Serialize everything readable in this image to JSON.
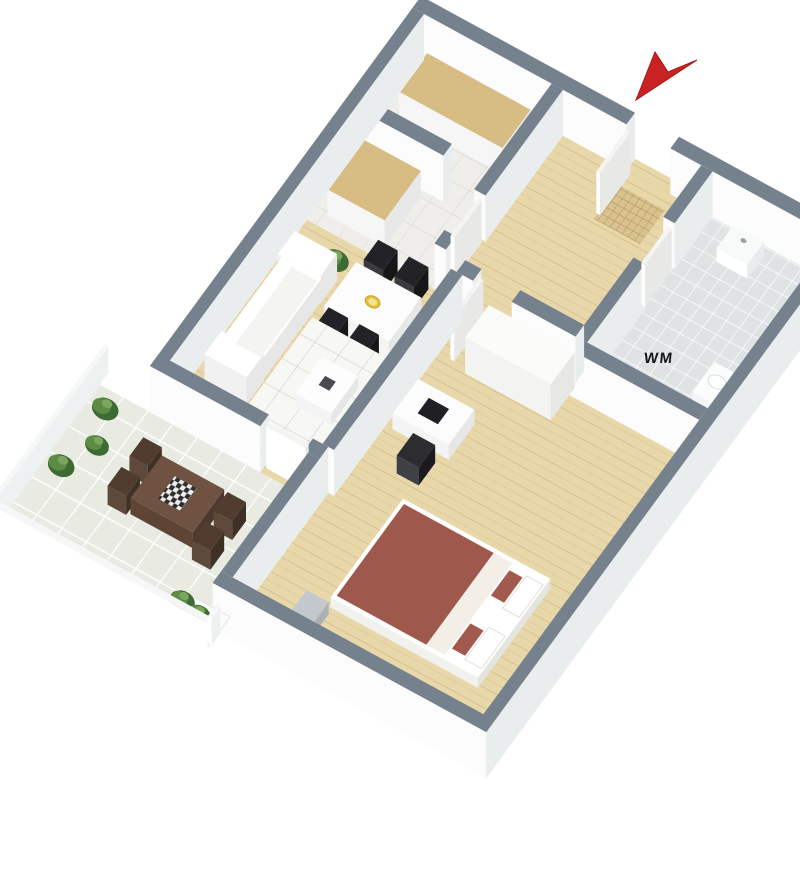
{
  "meta": {
    "title": "3D isometric floor plan - one-bedroom apartment with balcony",
    "background": "#ffffff"
  },
  "labels": {
    "washing_machine": "WM"
  },
  "view": {
    "eu": [
      44,
      24
    ],
    "ev": [
      -33,
      45
    ],
    "origin": [
      424,
      60
    ],
    "wall_height": 46,
    "canvas": [
      800,
      891
    ]
  },
  "palette": {
    "wall_cap": "#75828e",
    "wall_face_light": "#fcfcfc",
    "wall_face_dark": "#e9edee",
    "wood_floor": "#e8d7a9",
    "kitchen_floor": "#efeeea",
    "bath_floor": "#dfe3e4",
    "balcony_tile": "#e9ebe3",
    "counter_wood": "#d7bd84",
    "bed_red": "#9e584c",
    "arrow_red": "#c92222",
    "plant_green": "#3e6b33",
    "furniture_dark": "#232327"
  },
  "scene": {
    "items": [
      {
        "n": "kitchen-floor",
        "t": "floor",
        "x": 0,
        "y": 0,
        "w": 2.9,
        "h": 3.55,
        "pat": "patK"
      },
      {
        "n": "hall-floor",
        "t": "floor",
        "x": 2.9,
        "y": 0,
        "w": 3.4,
        "h": 3.55,
        "pat": "patWood"
      },
      {
        "n": "bathroom-floor",
        "t": "floor",
        "x": 6.3,
        "y": 0,
        "w": 3.0,
        "h": 3.8,
        "pat": "patBath"
      },
      {
        "n": "living-room-floor",
        "t": "floor",
        "x": 0,
        "y": 3.55,
        "w": 3.47,
        "h": 4.15,
        "pat": "patWood"
      },
      {
        "n": "bedroom-floor",
        "t": "floor",
        "x": 3.6,
        "y": 3.81,
        "w": 5.7,
        "h": 6.79,
        "pat": "patWood"
      },
      {
        "n": "balcony-floor",
        "t": "floor",
        "x": -1.5,
        "y": 7.96,
        "w": 4.94,
        "h": 3.14,
        "pat": "patBal"
      },
      {
        "n": "entry-threshold",
        "t": "flat",
        "x": 4.6,
        "y": -0.26,
        "w": 1.0,
        "h": 0.26,
        "pat": "patWood"
      },
      {
        "n": "kitchen-threshold",
        "t": "flat",
        "x": 2.9,
        "y": 2.35,
        "w": 0.26,
        "h": 0.9,
        "pat": "patWood"
      },
      {
        "n": "bath-threshold",
        "t": "flat",
        "x": 6.3,
        "y": 1.15,
        "w": 0.26,
        "h": 0.9,
        "pat": "patBath"
      },
      {
        "n": "bedroom-threshold",
        "t": "flat",
        "x": 3.97,
        "y": 3.55,
        "w": 0.88,
        "h": 0.26,
        "pat": "patWood"
      },
      {
        "n": "balcony-threshold",
        "t": "flat",
        "x": 2.25,
        "y": 7.7,
        "w": 1.0,
        "h": 0.26,
        "pat": "patWood"
      },
      {
        "n": "doormat",
        "t": "flat",
        "x": 4.65,
        "y": 0.3,
        "w": 1.05,
        "h": 0.75,
        "pat": "patMat"
      },
      {
        "n": "wall-top-left-segment",
        "t": "prism",
        "x": -0.26,
        "y": -0.26,
        "w": 4.86,
        "h": 0.26,
        "cap": "#75828e"
      },
      {
        "n": "wall-top-right-segment",
        "t": "prism",
        "x": 5.6,
        "y": -0.26,
        "w": 3.96,
        "h": 0.26,
        "cap": "#75828e"
      },
      {
        "n": "entrance-door",
        "t": "prism",
        "x": 4.62,
        "y": 0.02,
        "w": 0.09,
        "h": 0.92,
        "ht": 42,
        "cap": "#f4f4f2",
        "f1": "#ffffff",
        "f2": "#e8e8e6"
      },
      {
        "n": "bathroom-sink",
        "t": "prism",
        "x": 7.25,
        "y": 0.3,
        "w": 0.7,
        "h": 0.5,
        "z0": 8,
        "ht": 14,
        "cap": "#f8fafa",
        "f1": "#ffffff",
        "f2": "#e8ecee"
      },
      {
        "n": "sink-tap",
        "t": "dot",
        "x": 7.6,
        "y": 0.45,
        "z": 22,
        "r": 0.07,
        "fill": "#9aa4ab"
      },
      {
        "n": "kitchen-counter-far",
        "t": "prism",
        "x": 0.28,
        "y": 0.28,
        "w": 2.35,
        "h": 0.85,
        "ht": 26,
        "cap": "#d7bd84",
        "f1": "#f6f6f6",
        "f2": "#e8e8e8"
      },
      {
        "n": "kitchen-divider-wall",
        "t": "prism",
        "x": 0,
        "y": 1.82,
        "w": 2.0,
        "h": 0.26,
        "cap": "#75828e"
      },
      {
        "n": "kitchen-counter-near",
        "t": "prism",
        "x": 0.28,
        "y": 2.2,
        "w": 1.3,
        "h": 1.1,
        "ht": 26,
        "cap": "#d7bd84",
        "f1": "#f6f6f6",
        "f2": "#e8e8e8"
      },
      {
        "n": "kitchen-wall-a",
        "t": "prism",
        "x": 2.9,
        "y": 0,
        "w": 0.26,
        "h": 2.35,
        "cap": "#75828e"
      },
      {
        "n": "kitchen-wall-b",
        "t": "prism",
        "x": 2.9,
        "y": 3.25,
        "w": 0.26,
        "h": 0.3,
        "cap": "#75828e"
      },
      {
        "n": "kitchen-door",
        "t": "prism",
        "x": 3.02,
        "y": 2.4,
        "w": 0.09,
        "h": 0.82,
        "ht": 42,
        "cap": "#f4f4f2",
        "f1": "#ffffff",
        "f2": "#e8e8e6"
      },
      {
        "n": "wall-left-exterior",
        "t": "prism",
        "x": -0.26,
        "y": 0,
        "w": 0.26,
        "h": 7.96,
        "cap": "#75828e"
      },
      {
        "n": "bathroom-wall-a",
        "t": "prism",
        "x": 6.3,
        "y": 0,
        "w": 0.26,
        "h": 1.15,
        "cap": "#75828e"
      },
      {
        "n": "bathroom-wall-b",
        "t": "prism",
        "x": 6.3,
        "y": 2.05,
        "w": 0.26,
        "h": 1.75,
        "cap": "#75828e"
      },
      {
        "n": "bathroom-door",
        "t": "prism",
        "x": 6.44,
        "y": 1.2,
        "w": 0.09,
        "h": 0.8,
        "ht": 42,
        "cap": "#f4f4f2",
        "f1": "#ffffff",
        "f2": "#e8e8e6"
      },
      {
        "n": "toilet",
        "t": "prism",
        "x": 8.45,
        "y": 2.45,
        "w": 0.55,
        "h": 0.68,
        "ht": 11,
        "cap": "#fbfdfd",
        "f1": "#f2f5f5",
        "f2": "#e2e7e8"
      },
      {
        "n": "toilet-lid",
        "t": "dot",
        "x": 8.72,
        "y": 2.75,
        "z": 11,
        "r": 0.2,
        "fill": "#ffffff",
        "stroke": "#d9dee1"
      },
      {
        "n": "bathroom-bottom-wall",
        "t": "prism",
        "x": 6.3,
        "y": 3.8,
        "w": 3.0,
        "h": 0.26,
        "cap": "#75828e"
      },
      {
        "n": "hall-wall-a",
        "t": "prism",
        "x": 3.6,
        "y": 3.55,
        "w": 0.37,
        "h": 0.26,
        "cap": "#75828e"
      },
      {
        "n": "hall-wall-b",
        "t": "prism",
        "x": 4.85,
        "y": 3.55,
        "w": 1.45,
        "h": 0.26,
        "cap": "#75828e"
      },
      {
        "n": "bedroom-door",
        "t": "prism",
        "x": 3.99,
        "y": 3.64,
        "w": 0.09,
        "h": 0.88,
        "ht": 42,
        "cap": "#f4f4f2",
        "f1": "#ffffff",
        "f2": "#e8e8e6"
      },
      {
        "n": "dining-plant",
        "t": "plant",
        "x": 0.95,
        "y": 3.95,
        "r": 0.3
      },
      {
        "n": "dining-chair",
        "t": "prism",
        "x": 1.66,
        "y": 3.6,
        "w": 0.44,
        "h": 0.44,
        "ht": 22,
        "cap": "#232327",
        "f1": "#3a3a40",
        "f2": "#17171a"
      },
      {
        "n": "dining-chair",
        "t": "prism",
        "x": 2.36,
        "y": 3.6,
        "w": 0.44,
        "h": 0.44,
        "ht": 22,
        "cap": "#232327",
        "f1": "#3a3a40",
        "f2": "#17171a"
      },
      {
        "n": "dining-table",
        "t": "prism",
        "x": 1.52,
        "y": 4.08,
        "w": 1.48,
        "h": 0.98,
        "ht": 18,
        "cap": "#fcfcfc",
        "f1": "#f4f4f4",
        "f2": "#e6e8e8"
      },
      {
        "n": "fruit-bowl",
        "t": "dot",
        "x": 2.26,
        "y": 4.57,
        "z": 18,
        "r": 0.17,
        "fill": "#e6c23c",
        "stroke": "#c9a226"
      },
      {
        "n": "fruit-bowl-inner",
        "t": "dot",
        "x": 2.26,
        "y": 4.57,
        "z": 18,
        "r": 0.1,
        "fill": "#f4e49a"
      },
      {
        "n": "dining-chair",
        "t": "prism",
        "x": 1.66,
        "y": 5.1,
        "w": 0.44,
        "h": 0.44,
        "ht": 22,
        "cap": "#232327",
        "f1": "#3a3a40",
        "f2": "#17171a"
      },
      {
        "n": "dining-chair",
        "t": "prism",
        "x": 2.36,
        "y": 5.1,
        "w": 0.44,
        "h": 0.44,
        "ht": 22,
        "cap": "#232327",
        "f1": "#3a3a40",
        "f2": "#17171a"
      },
      {
        "n": "wardrobe",
        "t": "prism",
        "x": 4.4,
        "y": 3.9,
        "w": 1.95,
        "h": 0.72,
        "ht": 36,
        "cap": "#fbfbfa",
        "f1": "#f3f3f1",
        "f2": "#e7e7e4"
      },
      {
        "n": "living-rug",
        "t": "flat",
        "x": 1.25,
        "y": 5.05,
        "w": 2.2,
        "h": 2.5,
        "pat": "patRug"
      },
      {
        "n": "coffee-table",
        "t": "prism",
        "x": 2.02,
        "y": 5.78,
        "w": 0.82,
        "h": 0.82,
        "ht": 12,
        "cap": "#fdfdfd",
        "f1": "#f4f4f4",
        "f2": "#e6e8e8"
      },
      {
        "n": "coffee-table-item",
        "t": "flat",
        "x": 2.3,
        "y": 6.06,
        "w": 0.24,
        "h": 0.2,
        "z": 12,
        "fill": "#4a4a4f"
      },
      {
        "n": "sofa-arm",
        "t": "prism",
        "x": 0.26,
        "y": 4.26,
        "w": 0.96,
        "h": 0.52,
        "ht": 27,
        "cap": "#ffffff",
        "f1": "#f1f1f1",
        "f2": "#e7e7e7"
      },
      {
        "n": "sofa",
        "t": "prism",
        "x": 0.3,
        "y": 4.7,
        "w": 0.9,
        "h": 1.85,
        "ht": 22,
        "cap": "#ffffff",
        "f1": "#f1f1f1",
        "f2": "#e7e7e7"
      },
      {
        "n": "sofa-arm",
        "t": "prism",
        "x": 0.26,
        "y": 6.48,
        "w": 0.96,
        "h": 0.52,
        "ht": 27,
        "cap": "#ffffff",
        "f1": "#f1f1f1",
        "f2": "#e7e7e7"
      },
      {
        "n": "sofa-seat",
        "t": "flat",
        "x": 0.58,
        "y": 4.78,
        "w": 0.58,
        "h": 1.7,
        "z": 22,
        "fill": "#f4f4f1"
      },
      {
        "n": "tv-screen",
        "t": "prism",
        "x": 3.3,
        "y": 5.2,
        "w": 0.14,
        "h": 1.25,
        "ht": 26,
        "cap": "#161618",
        "f1": "#2e2e33",
        "f2": "#0e0e10"
      },
      {
        "n": "living-bedroom-wall",
        "t": "prism",
        "x": 3.47,
        "y": 3.81,
        "w": 0.26,
        "h": 3.89,
        "cap": "#75828e"
      },
      {
        "n": "desk",
        "t": "prism",
        "x": 3.88,
        "y": 5.35,
        "w": 1.28,
        "h": 0.78,
        "ht": 15,
        "cap": "#fcfcfc",
        "f1": "#f4f4f4",
        "f2": "#e6e8e8"
      },
      {
        "n": "laptop",
        "t": "flat",
        "x": 4.28,
        "y": 5.56,
        "w": 0.46,
        "h": 0.34,
        "z": 15,
        "fill": "#202024"
      },
      {
        "n": "desk-chair",
        "t": "prism",
        "x": 4.48,
        "y": 6.3,
        "w": 0.5,
        "h": 0.5,
        "ht": 18,
        "cap": "#2c2c31",
        "f1": "#3f3f46",
        "f2": "#1b1b1f"
      },
      {
        "n": "living-balcony-wall-a",
        "t": "prism",
        "x": -0.26,
        "y": 7.7,
        "w": 2.51,
        "h": 0.26,
        "cap": "#75828e"
      },
      {
        "n": "living-balcony-wall-b",
        "t": "prism",
        "x": 3.25,
        "y": 7.7,
        "w": 0.35,
        "h": 0.26,
        "cap": "#75828e"
      },
      {
        "n": "balcony-door",
        "t": "prism",
        "x": 2.3,
        "y": 7.76,
        "w": 0.9,
        "h": 0.09,
        "ht": 42,
        "cap": "#f4f4f2",
        "f1": "#ffffff",
        "f2": "#e8e8e6"
      },
      {
        "n": "bedroom-left-wall",
        "t": "prism",
        "x": 3.34,
        "y": 7.96,
        "w": 0.26,
        "h": 2.64,
        "cap": "#75828e"
      },
      {
        "n": "bed-frame",
        "t": "prism",
        "x": 5.0,
        "y": 7.3,
        "w": 3.35,
        "h": 2.2,
        "ht": 10,
        "cap": "#ffffff",
        "f1": "#f1f1ee",
        "f2": "#e4e4e0"
      },
      {
        "n": "bed-mattress",
        "t": "flat",
        "x": 5.08,
        "y": 7.38,
        "w": 2.04,
        "h": 2.04,
        "z": 10,
        "fill": "#9e584c"
      },
      {
        "n": "bed-sheet-band",
        "t": "flat",
        "x": 7.12,
        "y": 7.38,
        "w": 0.42,
        "h": 2.04,
        "z": 10,
        "fill": "#f3efe7"
      },
      {
        "n": "bed-cushion",
        "t": "flat",
        "x": 7.58,
        "y": 7.52,
        "w": 0.3,
        "h": 0.56,
        "z": 10,
        "fill": "#a25a4e"
      },
      {
        "n": "bed-cushion",
        "t": "flat",
        "x": 7.58,
        "y": 8.7,
        "w": 0.3,
        "h": 0.56,
        "z": 10,
        "fill": "#a25a4e"
      },
      {
        "n": "bed-pillow",
        "t": "flat",
        "x": 7.92,
        "y": 7.46,
        "w": 0.38,
        "h": 0.72,
        "z": 10,
        "fill": "#ffffff",
        "stroke": "#dcdcda"
      },
      {
        "n": "bed-pillow",
        "t": "flat",
        "x": 7.92,
        "y": 8.6,
        "w": 0.38,
        "h": 0.72,
        "z": 10,
        "fill": "#ffffff",
        "stroke": "#dcdcda"
      },
      {
        "n": "nightstand",
        "t": "prism",
        "x": 4.55,
        "y": 9.62,
        "w": 0.5,
        "h": 0.5,
        "ht": 12,
        "cap": "#c2c8cc",
        "f1": "#dfe3e6",
        "f2": "#aab1b6"
      },
      {
        "n": "wall-right-exterior",
        "t": "prism",
        "x": 9.3,
        "y": 0,
        "w": 0.26,
        "h": 10.86,
        "cap": "#75828e"
      },
      {
        "n": "bedroom-bottom-wall",
        "t": "prism",
        "x": 3.34,
        "y": 10.6,
        "w": 6.22,
        "h": 0.26,
        "cap": "#75828e"
      },
      {
        "n": "balcony-plant",
        "t": "plant",
        "x": -1.02,
        "y": 8.3,
        "r": 0.3
      },
      {
        "n": "balcony-plant",
        "t": "plant",
        "x": -0.72,
        "y": 8.95,
        "r": 0.27
      },
      {
        "n": "balcony-plant",
        "t": "plant",
        "x": -1.06,
        "y": 9.58,
        "r": 0.3
      },
      {
        "n": "balcony-chair",
        "t": "prism",
        "x": 0.16,
        "y": 8.72,
        "w": 0.42,
        "h": 0.42,
        "ht": 19,
        "cap": "#503d2f",
        "f1": "#5d4a3a",
        "f2": "#3f3025"
      },
      {
        "n": "balcony-chair",
        "t": "prism",
        "x": 0.16,
        "y": 9.38,
        "w": 0.42,
        "h": 0.42,
        "ht": 19,
        "cap": "#503d2f",
        "f1": "#5d4a3a",
        "f2": "#3f3025"
      },
      {
        "n": "balcony-table",
        "t": "prism",
        "x": 0.64,
        "y": 8.8,
        "w": 1.42,
        "h": 0.95,
        "ht": 16,
        "cap": "#6f5241",
        "f1": "#5d4435",
        "f2": "#4e3930"
      },
      {
        "n": "balcony-tablecloth",
        "t": "flat",
        "x": 1.1,
        "y": 9.02,
        "w": 0.5,
        "h": 0.5,
        "z": 16,
        "pat": "patCheck"
      },
      {
        "n": "balcony-chair",
        "t": "prism",
        "x": 2.18,
        "y": 8.86,
        "w": 0.42,
        "h": 0.42,
        "ht": 19,
        "cap": "#503d2f",
        "f1": "#5d4a3a",
        "f2": "#3f3025"
      },
      {
        "n": "balcony-chair",
        "t": "prism",
        "x": 2.18,
        "y": 9.52,
        "w": 0.42,
        "h": 0.42,
        "ht": 19,
        "cap": "#503d2f",
        "f1": "#5d4a3a",
        "f2": "#3f3025"
      },
      {
        "n": "planter-box",
        "t": "flat",
        "x": 2.28,
        "y": 10.52,
        "w": 1.2,
        "h": 0.5,
        "fill": "#fcfcfc",
        "stroke": "#e2e2df"
      },
      {
        "n": "planter-plant",
        "t": "plant",
        "x": 2.52,
        "y": 10.68,
        "r": 0.28
      },
      {
        "n": "planter-plant",
        "t": "plant",
        "x": 2.95,
        "y": 10.76,
        "r": 0.27
      },
      {
        "n": "planter-plant",
        "t": "plant",
        "x": 3.28,
        "y": 10.86,
        "r": 0.23
      },
      {
        "n": "balcony-railing-left",
        "t": "prism",
        "x": -1.5,
        "y": 7.7,
        "w": 0.1,
        "h": 3.5,
        "ht": 26,
        "cap": "#f6f8f8",
        "f1": "#ffffff",
        "f2": "#eef1f1"
      },
      {
        "n": "balcony-railing-front",
        "t": "prism",
        "x": -1.5,
        "y": 11.1,
        "w": 5.0,
        "h": 0.12,
        "ht": 26,
        "cap": "#f6f8f8",
        "f1": "#ffffff",
        "f2": "#eef1f1"
      },
      {
        "n": "balcony-railing-right",
        "t": "prism",
        "x": 3.42,
        "y": 10.86,
        "w": 0.1,
        "h": 0.26,
        "ht": 26,
        "cap": "#f6f8f8",
        "f1": "#ffffff",
        "f2": "#eef1f1"
      },
      {
        "n": "entrance-arrow-icon",
        "t": "poly",
        "pts": "636,100 655,52 668,72 697,60",
        "fill": "#c92222",
        "stroke": "#a31818"
      }
    ]
  }
}
